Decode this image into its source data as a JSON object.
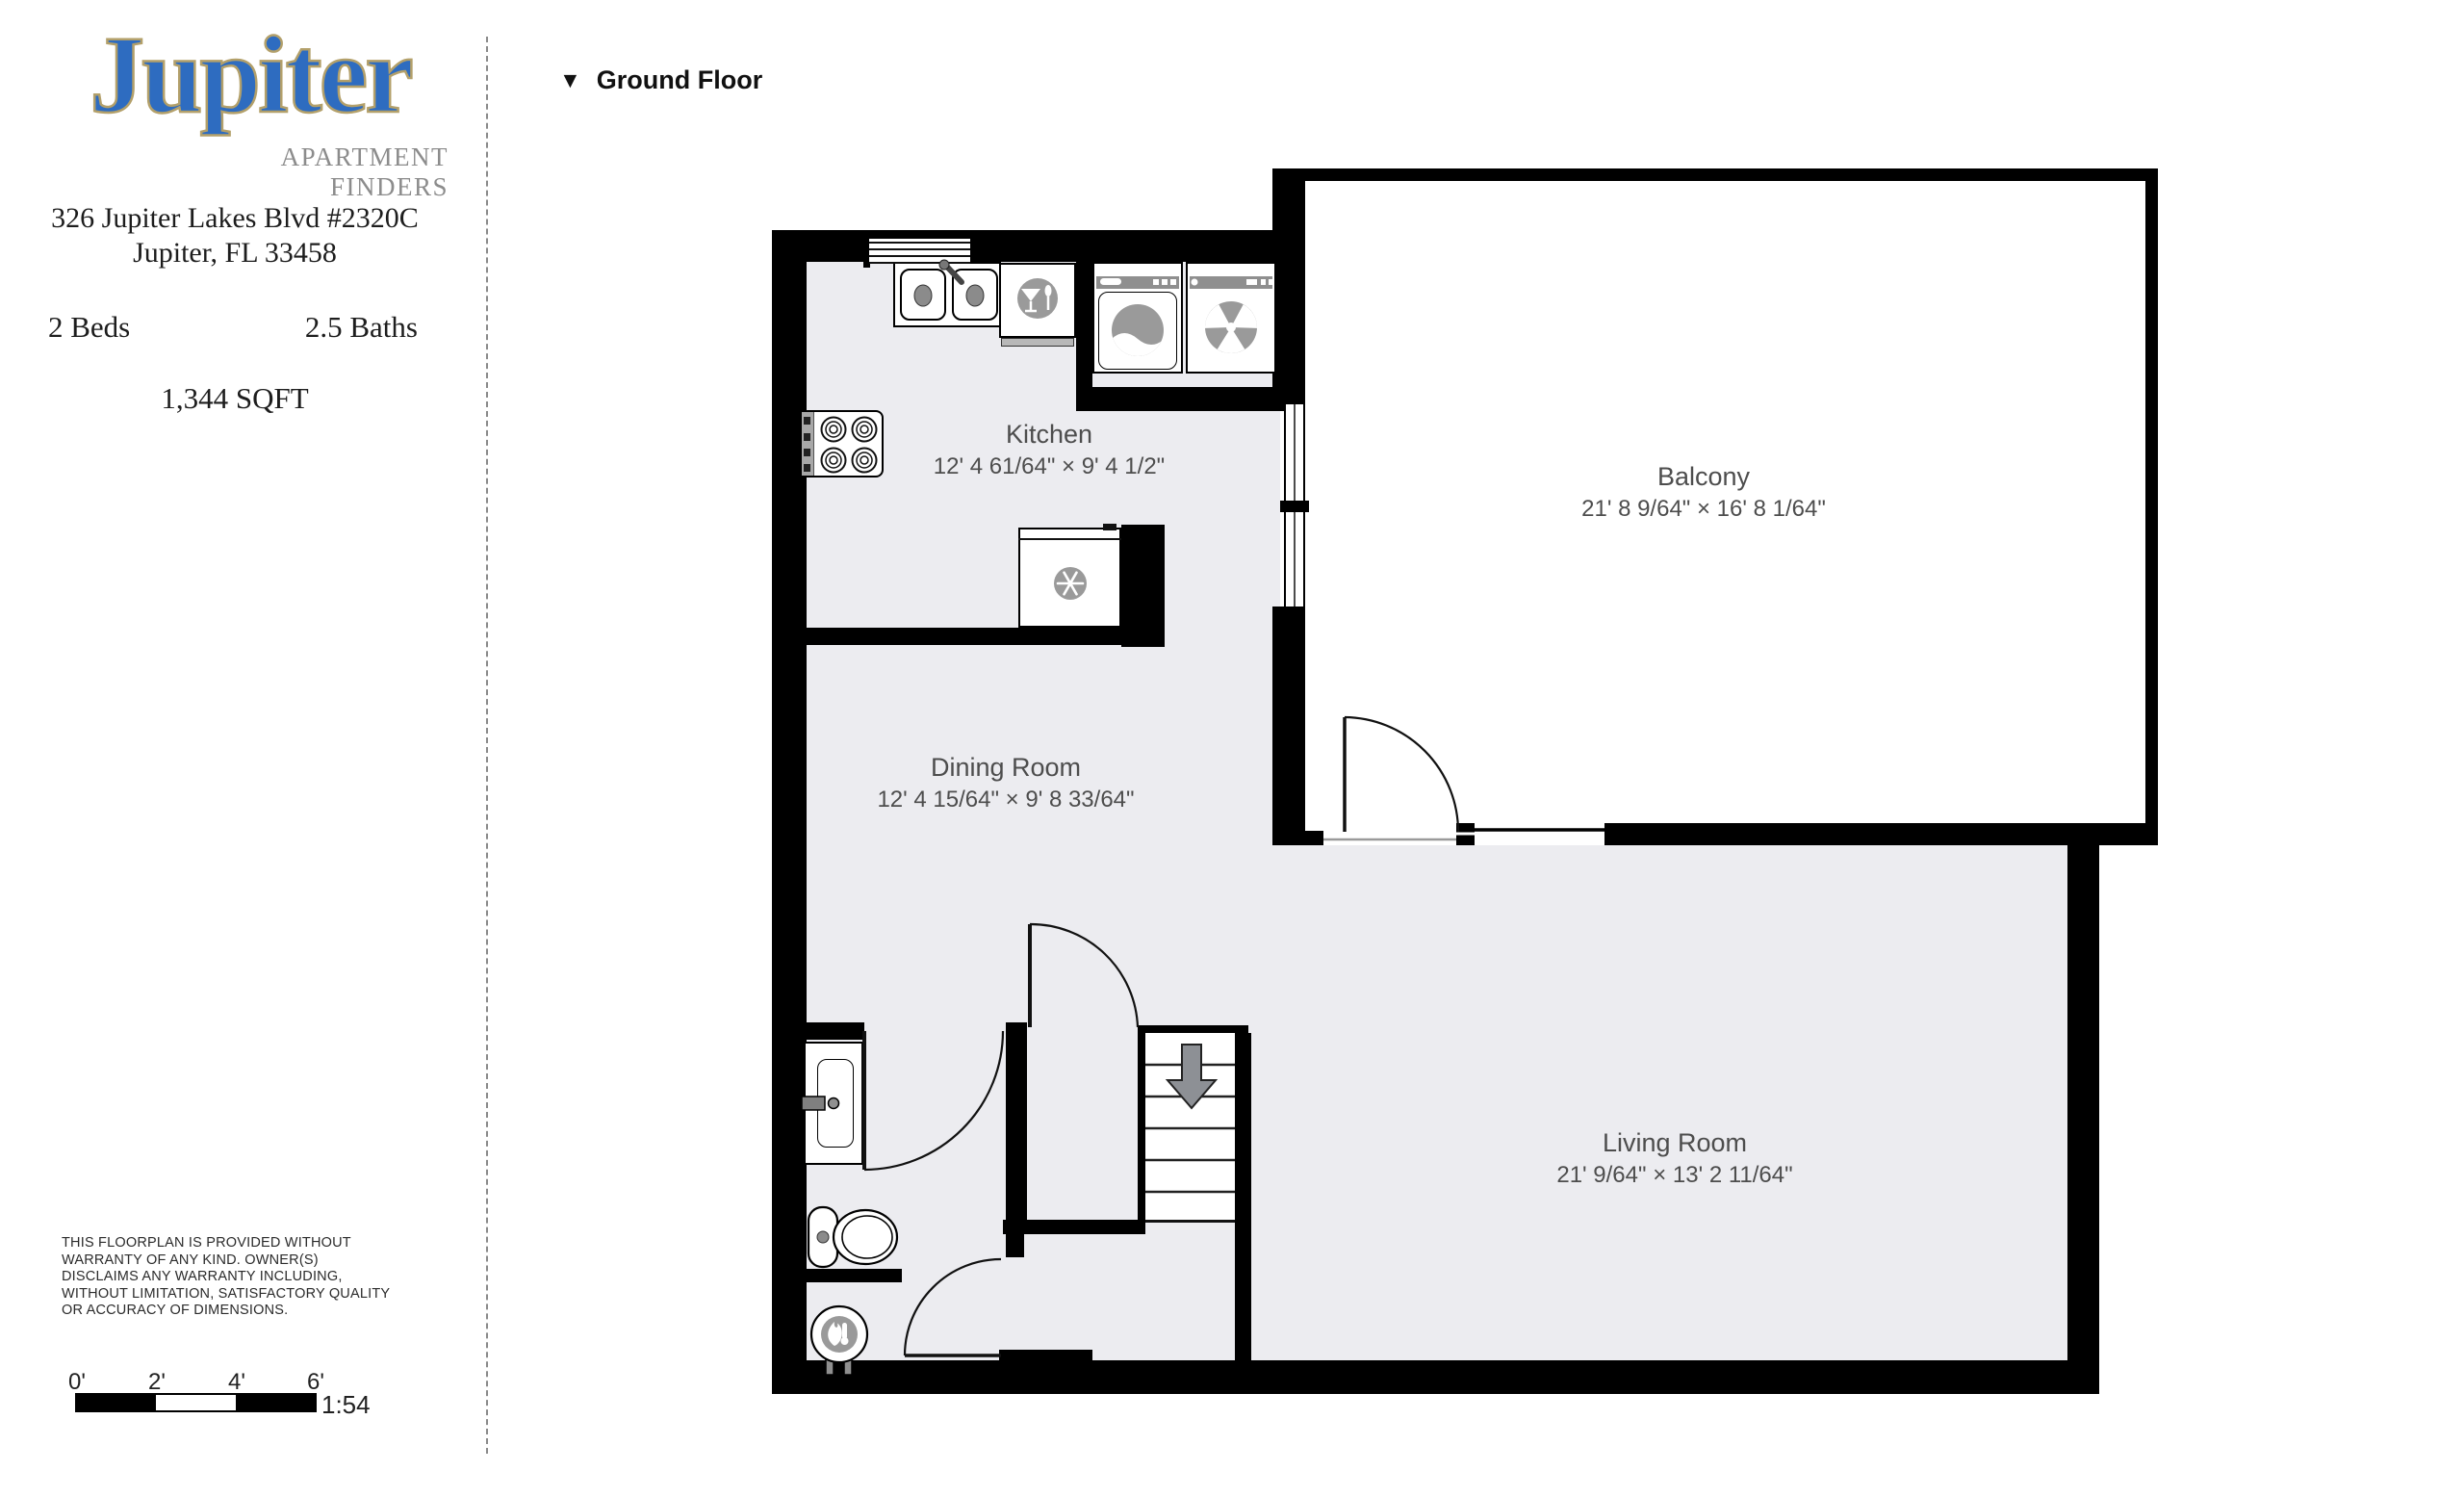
{
  "branding": {
    "logo": "Jupiter",
    "tagline": "APARTMENT FINDERS",
    "logo_blue": "#2e6cc0",
    "logo_outline": "#b3a06a"
  },
  "listing": {
    "address_line1": "326 Jupiter Lakes Blvd #2320C",
    "address_line2": "Jupiter, FL 33458",
    "beds": "2 Beds",
    "baths": "2.5 Baths",
    "sqft": "1,344 SQFT"
  },
  "floor_selector": {
    "icon": "▼",
    "label": "Ground Floor"
  },
  "rooms": [
    {
      "name": "Kitchen",
      "dims": "12' 4 61/64\" × 9' 4 1/2\""
    },
    {
      "name": "Dining Room",
      "dims": "12' 4 15/64\" × 9' 8 33/64\""
    },
    {
      "name": "Balcony",
      "dims": "21' 8 9/64\" × 16' 8 1/64\""
    },
    {
      "name": "Living Room",
      "dims": "21' 9/64\" × 13' 2 11/64\""
    }
  ],
  "fixture_icons": [
    "double-sink",
    "dishwasher-wineglass-icon",
    "washer-icon",
    "dryer-fan-icon",
    "stove-burners",
    "fridge-snowflake-icon",
    "vanity-sink",
    "toilet",
    "water-heater-flame-icon",
    "stairs-down-arrow"
  ],
  "disclaimer": "THIS FLOORPLAN IS PROVIDED WITHOUT\nWARRANTY OF ANY KIND. OWNER(S)\nDISCLAIMS ANY WARRANTY INCLUDING,\nWITHOUT LIMITATION, SATISFACTORY QUALITY\nOR ACCURACY OF DIMENSIONS.",
  "scale_bar": {
    "ticks": [
      "0'",
      "2'",
      "4'",
      "6'"
    ],
    "ratio": "1:54"
  },
  "colors": {
    "wall": "#000000",
    "floor": "#ececf0",
    "appliance_gray": "#9a9a9a",
    "label_gray": "#4d4d4d"
  }
}
